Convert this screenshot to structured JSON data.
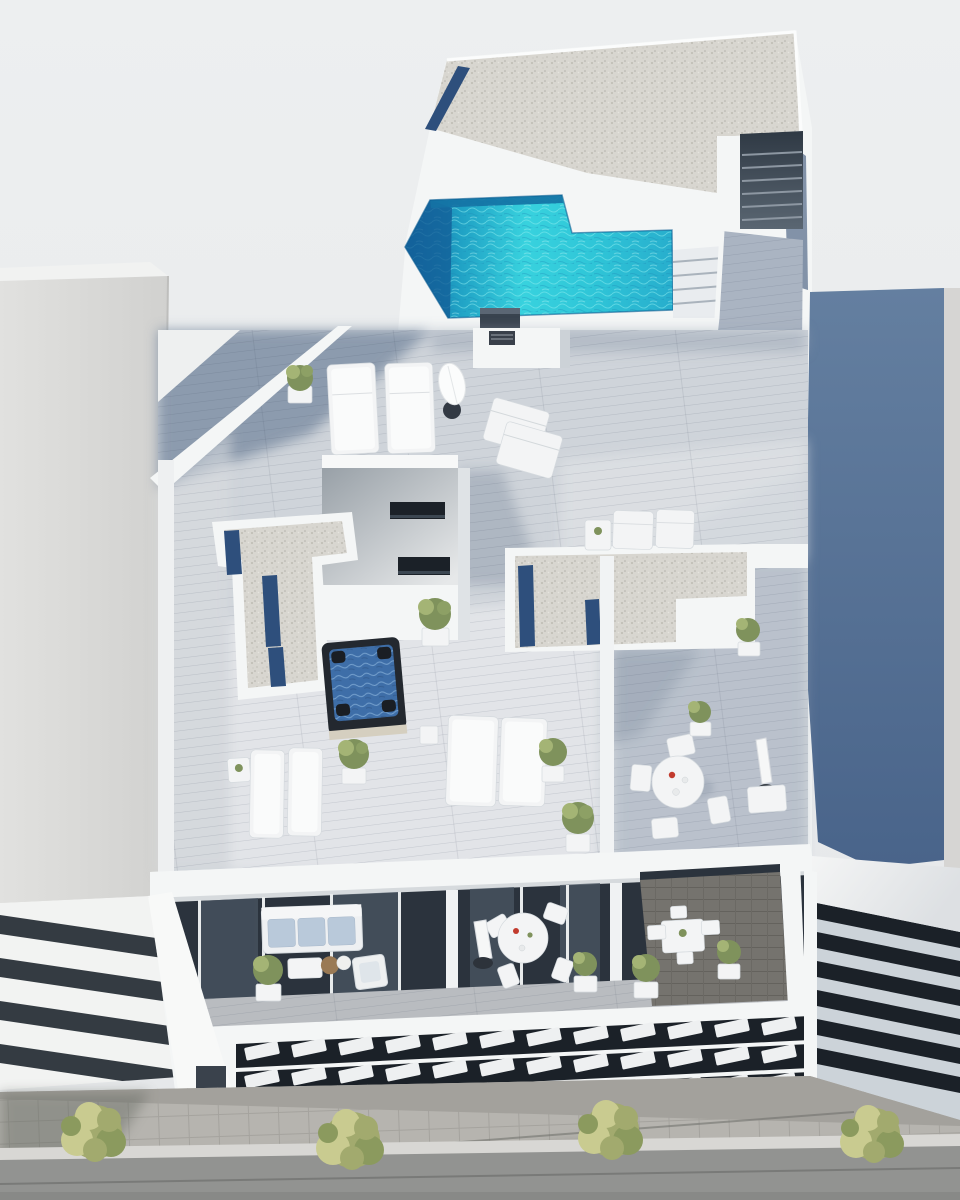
{
  "scene": {
    "type": "3d-architectural-render",
    "view": "aerial top-down perspective",
    "description": "Aerial 3D render of a modern white residential building with rooftop swimming pool, gravel roof, wooden deck terraces with sun loungers, jacuzzi, dining sets, balconies with louvered facade, sidewalk with trees and adjacent buildings"
  },
  "colors": {
    "bg": "#e9ebec",
    "building_white": "#f4f6f6",
    "white_shadow": "#ccd2d7",
    "left_building": "#dbdbd9",
    "gravel": "#d8d6d0",
    "planter_blue": "#2e4f7c",
    "pool_deep": "#1668a0",
    "pool_turquoise": "#38d2de",
    "pool_mid": "#27aecd",
    "deck_light": "#cfd4da",
    "deck_mid": "#aab4c2",
    "deck_dark": "#8090a6",
    "blue_wall_top": "#647fa0",
    "blue_wall_bottom": "#49648a",
    "glass_dark": "#2b333d",
    "louver_white": "#eef0f1",
    "cushion": "#b9c9da",
    "plant_green": "#7f925c",
    "plant_light": "#a4b475",
    "tree_green": "#a2aa6e",
    "tree_light": "#c9cb90",
    "tree_dark": "#8b9a5e",
    "pavement": "#b6b4af",
    "street": "#929391",
    "terrace_tile": "#75736e",
    "jacuzzi_rim": "#23282f",
    "jacuzzi_water": "#3e6ea8",
    "wood_table": "#9a7a55",
    "red_accent": "#c23b2e"
  },
  "objects": {
    "labels": [
      "rooftop-pool",
      "gravel-roof",
      "roof-planter",
      "stair-opening",
      "outdoor-stairs",
      "walkway-deck",
      "terrace-deck",
      "stairwell-penthouse",
      "ac-unit",
      "l-planter",
      "skylight-strip",
      "jacuzzi",
      "sun-lounger",
      "deck-chair",
      "parasol",
      "dining-table",
      "dining-chair",
      "side-table",
      "potted-plant",
      "divider-wall",
      "balcony-sofa",
      "coffee-table",
      "armchair",
      "round-table",
      "louver-facade",
      "entrance-door",
      "sidewalk",
      "street",
      "tree",
      "left-neighbor-building",
      "right-neighbor-building",
      "blue-side-wall"
    ]
  }
}
